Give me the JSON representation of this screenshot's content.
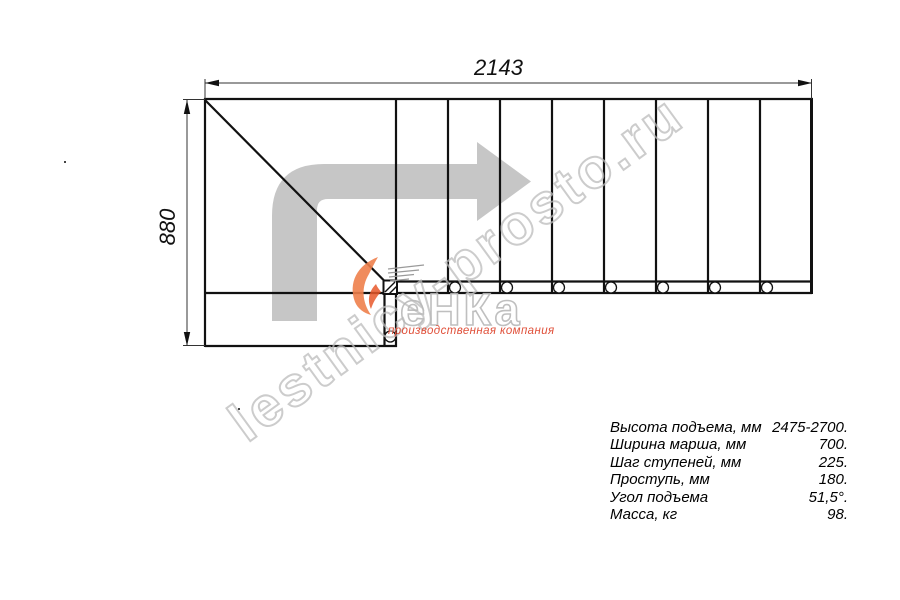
{
  "drawing": {
    "title": "stair-plan-top-view",
    "dim_width_label": "2143",
    "dim_height_label": "880",
    "step_count": 8,
    "bolt_circle_count": 7
  },
  "specs": {
    "rows": [
      {
        "label": "Высота подъема, мм",
        "value": "2475-2700."
      },
      {
        "label": "Ширина марша, мм",
        "value": "700."
      },
      {
        "label": "Шаг ступеней, мм",
        "value": "225."
      },
      {
        "label": "Проступь, мм",
        "value": "180."
      },
      {
        "label": "Угол подъема",
        "value": "51,5°."
      },
      {
        "label": "Масса, кг",
        "value": "98."
      }
    ]
  },
  "watermark": {
    "site": "lestnicy-prosto.ru"
  },
  "logo": {
    "word": "еНКа",
    "subtitle": "производственная компания"
  },
  "colors": {
    "line": "#111111",
    "arrow_gray": "#c6c6c6",
    "watermark_gray": "#bcbcbc",
    "logo_red": "#e0503a",
    "flame_orange": "#ee7f4b"
  }
}
